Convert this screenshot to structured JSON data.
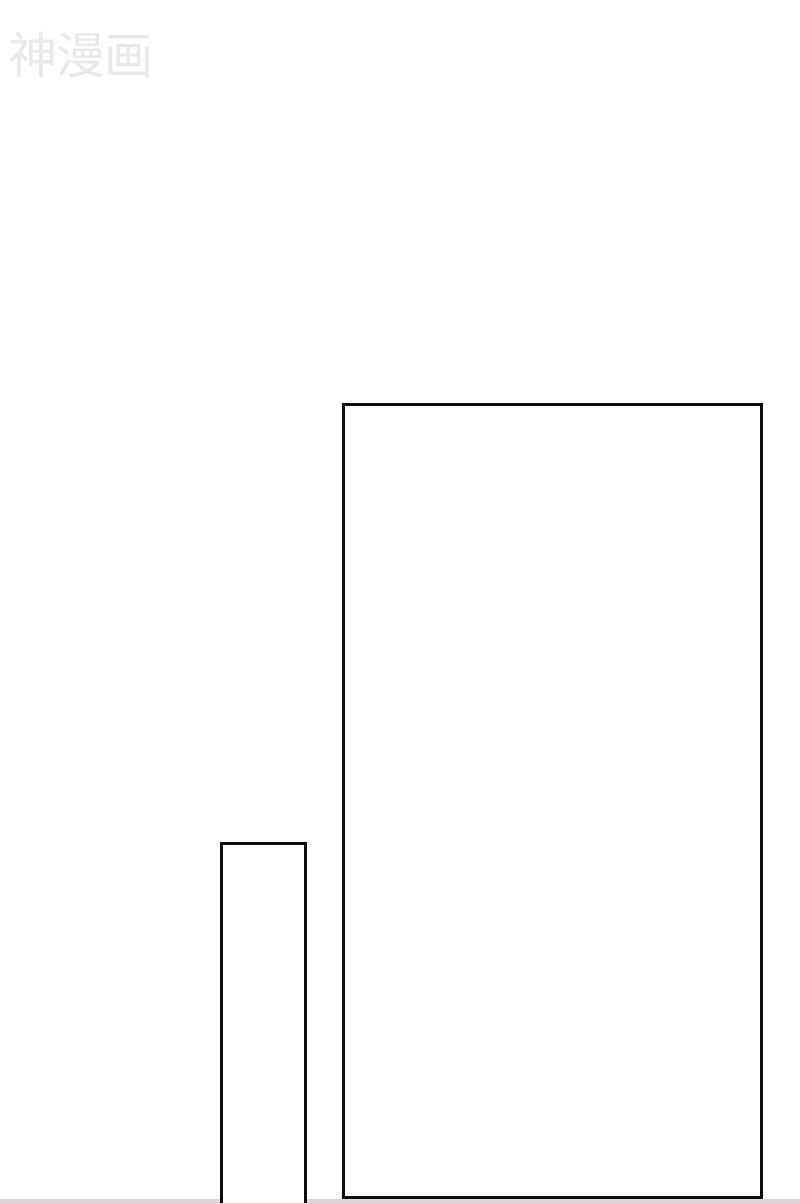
{
  "watermark": {
    "text": "神漫画",
    "color": "#e8e8e8"
  },
  "page": {
    "background": "#ffffff",
    "panel_border_color": "#0c0c0c",
    "bottom_divider_color": "#d9dae6"
  }
}
